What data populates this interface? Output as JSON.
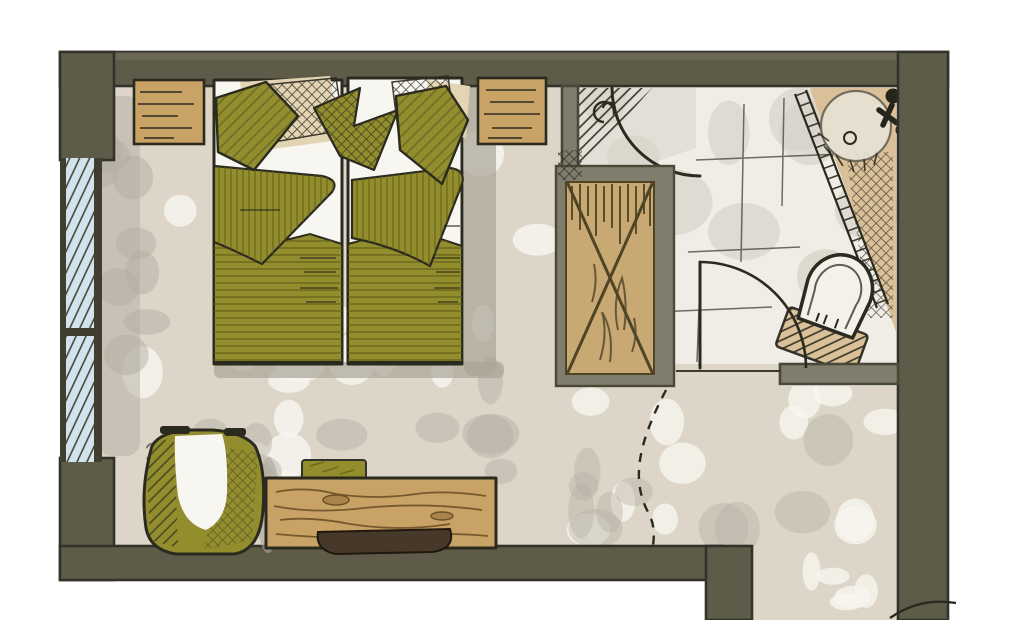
{
  "scene": {
    "type": "hand-drawn-floor-plan-sketch",
    "objects": {
      "window": "window",
      "beds": "twin-beds",
      "nightstands": "nightstands",
      "wardrobe": "wardrobe",
      "shower": "shower",
      "vanity": "vanity-sink",
      "toilet": "toilet",
      "bath_door": "bathroom-door-swing",
      "entry_swing": "dashed-door-swing",
      "armchair": "armchair",
      "desk": "desk",
      "stool": "stool",
      "tray": "tray"
    }
  },
  "palette": {
    "paper": "#ffffff",
    "ink": "#2b2a1f",
    "wall": {
      "core": "#5e5c49",
      "edge": "#33322a",
      "light": "#75735f",
      "partition": "#807d6d",
      "partition_edge": "#4a4938"
    },
    "window": {
      "glass": "#d3e3ec",
      "frame": "#3f3e2f"
    },
    "floor": {
      "carpet": "#dcd5c8",
      "blotch_white": "#f7f5ef",
      "blotch_gray": "#b4aea2",
      "shadow": "#aaa496",
      "bath": "#f0ede6",
      "bath_wash": "#d7d3c9",
      "tile_line": "#4a4a3e"
    },
    "furniture": {
      "olive": "#928e2e",
      "olive_dark": "#5f5c18",
      "wood": "#c9a266",
      "wood_mid": "#c8a873",
      "wood_dark": "#6e5128",
      "wood_knot": "#a9824c",
      "grain_dark": "#4f4426",
      "tray": "#46392a",
      "tray_edge": "#20180e",
      "sheet": "#f8f6f0",
      "pillow_tan": "#e3d4b3"
    },
    "fixtures": {
      "porcelain": "#f3f1ea",
      "basin": "#e7e0d2",
      "basin_rim": "#6f685a",
      "metal": "#26251b",
      "counter": "#d9bf96"
    }
  }
}
